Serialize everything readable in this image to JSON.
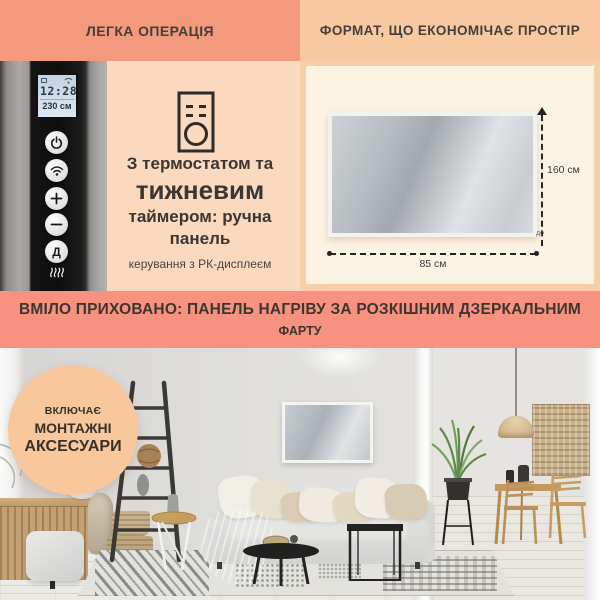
{
  "sections": {
    "easy_operation": {
      "title": "ЛЕГКА ОПЕРАЦІЯ",
      "device": {
        "lcd_time": "12:28",
        "lcd_reading": "230 см",
        "day_button_label": "Д"
      },
      "text_line1": "З термостатом та",
      "text_line2": "тижневим",
      "text_line3": "таймером: ручна панель",
      "text_line4": "керування з РК-дисплеєм"
    },
    "space_saving": {
      "title": "ФОРМАТ, ЩО ЕКОНОМІЧАЄ ПРОСТІР",
      "height_label": "160 см",
      "width_label": "85 см",
      "upto_label": "до"
    },
    "banner": {
      "line1": "ВМІЛО ПРИХОВАНО: ПАНЕЛЬ НАГРІВУ ЗА РОЗКІШНИМ ДЗЕРКАЛЬНИМ",
      "line2": "ФАРТУ"
    },
    "badge": {
      "line1": "ВКЛЮЧАЄ",
      "line2": "МОНТАЖНІ",
      "line3": "АКСЕСУАРИ"
    }
  },
  "icons": [
    "power-icon",
    "wifi-icon",
    "plus-icon",
    "minus-icon",
    "day-button",
    "heating-element-icon",
    "remote-control-icon",
    "lcd-calendar-icon",
    "lcd-wifi-icon",
    "dimension-arrow-icon"
  ],
  "colors": {
    "salmon_header": "#F2997E",
    "salmon_banner": "#F6927F",
    "peach_header": "#F8C9A1",
    "peach_panel": "#FAD9BE",
    "peach_frame": "#F8CEA7",
    "cream": "#FDF3E3",
    "badge_circle": "#F8C79C",
    "lcd_screen": "#C9D9E6"
  }
}
